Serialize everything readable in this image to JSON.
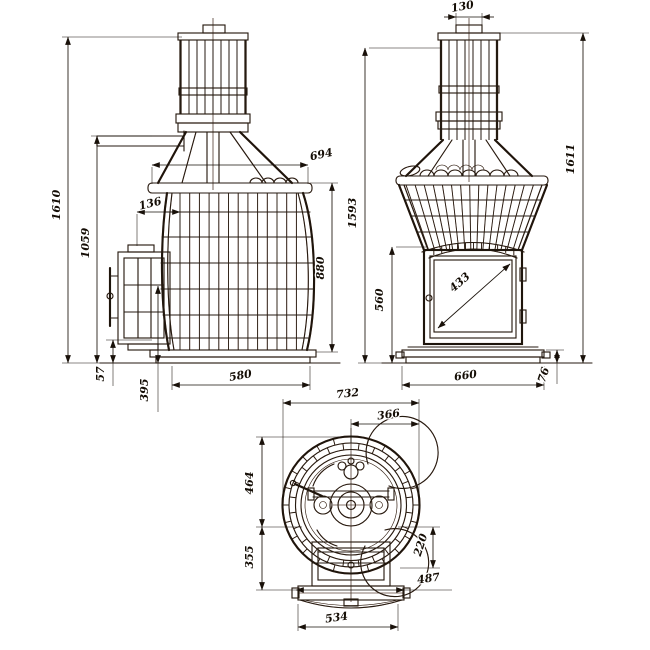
{
  "drawing": {
    "type": "three-view stove dimension drawing",
    "colors": {
      "line": "#1e150c",
      "scan_tint": "#8c2812",
      "background": "#ffffff"
    }
  },
  "views": {
    "side": {
      "name": "side view",
      "dims": {
        "total_height": "1610",
        "flue_outlet_height": "1059",
        "top_inset": "136",
        "upper_depth": "694",
        "body_height": "880",
        "plinth_height": "57",
        "lower_height": "395",
        "overall_depth": "580"
      }
    },
    "front": {
      "name": "front view",
      "dims": {
        "chimney_diameter": "130",
        "overall_height": "1611",
        "casing_height": "1593",
        "firebox_height": "560",
        "glass_diagonal": "433",
        "overall_width": "660",
        "plinth_height": "76"
      }
    },
    "top": {
      "name": "top view",
      "dims": {
        "overall_width": "732",
        "half_width": "366",
        "rear_half_depth": "464",
        "front_half_depth": "355",
        "door_projection": "220",
        "base_width": "487",
        "base_plate_width": "534"
      }
    }
  }
}
